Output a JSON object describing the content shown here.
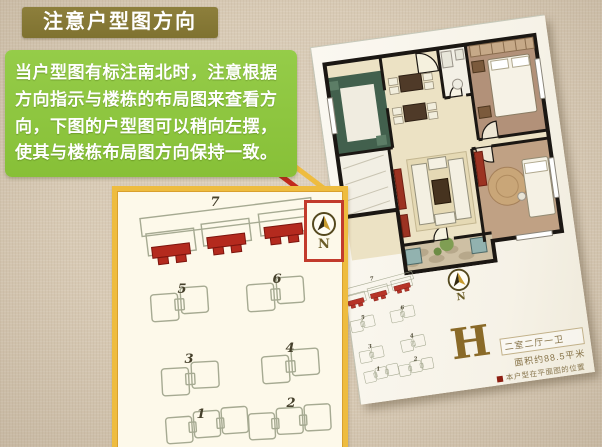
{
  "title_banner": {
    "text": "注意户型图方向"
  },
  "description_box": {
    "lines": [
      "当户型图有标注南北时，注意根据",
      "方向指示与楼栋的布局图来查看方",
      "向，下图的户型图可以稍向左摆，",
      "使其与楼栋布局图方向保持一致。"
    ]
  },
  "site_plan": {
    "building_numbers": [
      "7",
      "5",
      "6",
      "3",
      "4",
      "1",
      "2"
    ],
    "compass": {
      "label": "N"
    }
  },
  "floor_plan_sheet": {
    "unit_letter": "H",
    "unit_type": "二室二厅一卫",
    "unit_area": "面积约88.5平米",
    "legend": "本户型在平面图的位置",
    "compass": {
      "label": "N"
    }
  },
  "colors": {
    "banner_bg": "#84773a",
    "description_bg": "#8dc63f",
    "panel_border": "#eebc3f",
    "panel_bg": "#fdf9ea",
    "highlight_red": "#b42a1e",
    "callout_red": "#c3291d",
    "compass_box_border": "#c23b2c",
    "unit_letter_color": "#8a6a28"
  }
}
